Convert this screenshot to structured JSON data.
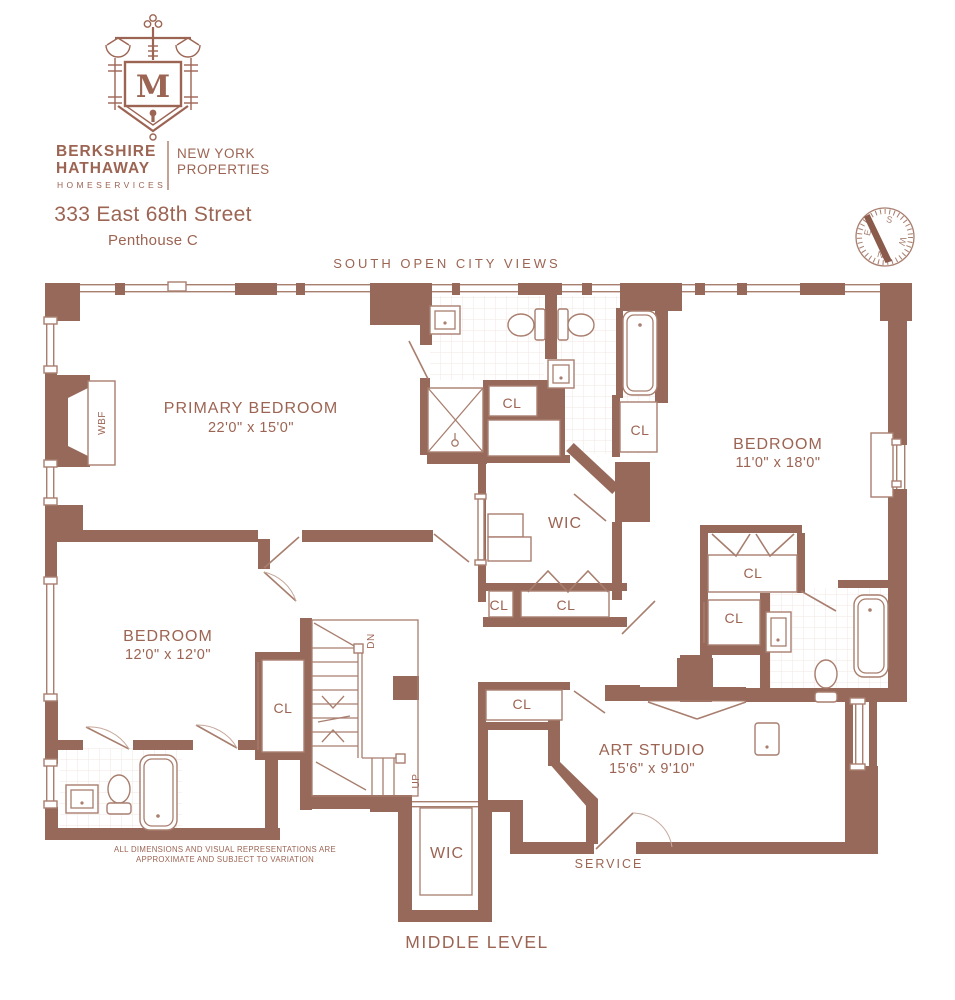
{
  "header": {
    "monogram": "M",
    "brand_line1": "BERKSHIRE",
    "brand_line2": "HATHAWAY",
    "brand_line3": "HOMESERVICES",
    "brand_right1": "NEW YORK",
    "brand_right2": "PROPERTIES",
    "address": "333 East 68th Street",
    "unit": "Penthouse C"
  },
  "compass": {
    "north": "N",
    "south": "S",
    "east": "E",
    "west": "W"
  },
  "plan": {
    "orientation_note": "SOUTH  OPEN  CITY  VIEWS",
    "level": "MIDDLE LEVEL",
    "disclaimer_line1": "ALL DIMENSIONS AND VISUAL REPRESENTATIONS ARE",
    "disclaimer_line2": "APPROXIMATE AND SUBJECT TO VARIATION",
    "rooms": {
      "primary_bedroom": {
        "name": "PRIMARY BEDROOM",
        "dims": "22'0\" x 15'0\""
      },
      "bedroom_right": {
        "name": "BEDROOM",
        "dims": "11'0\" x 18'0\""
      },
      "bedroom_left": {
        "name": "BEDROOM",
        "dims": "12'0\" x 12'0\""
      },
      "art_studio": {
        "name": "ART STUDIO",
        "dims": "15'6\" x 9'10\""
      }
    },
    "labels": {
      "closet": "CL",
      "walk_in_closet": "WIC",
      "fireplace": "WBF",
      "stairs_down": "DN",
      "stairs_up": "UP",
      "service": "SERVICE"
    }
  },
  "colors": {
    "wall": "#96695A",
    "text": "#9C6453",
    "line": "#A87E6E",
    "tile": "#F0E6E0"
  }
}
